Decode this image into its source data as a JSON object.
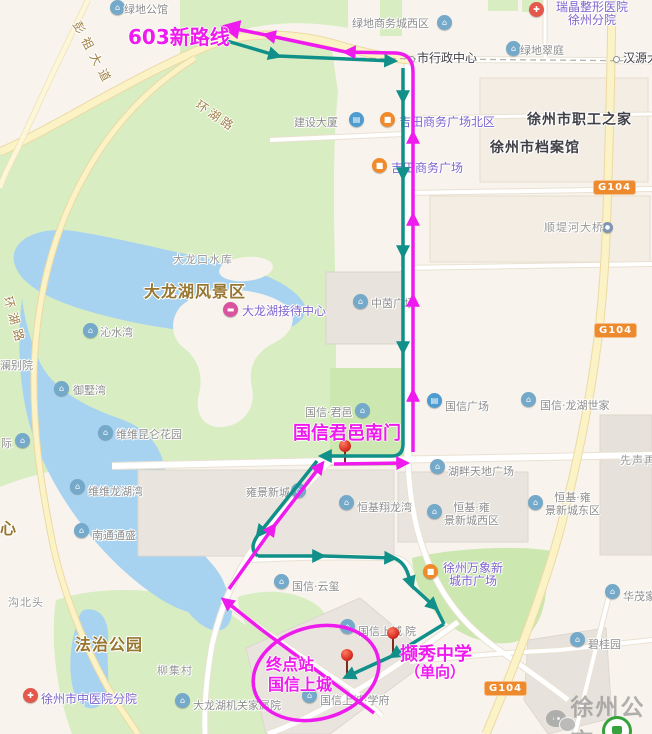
{
  "map": {
    "colors": {
      "route_outbound": "#ef1bee",
      "route_inbound": "#11908a",
      "badge_orange": "#ee8a2e",
      "water": "#a8d3f0",
      "park": "#d8edc2"
    },
    "route": {
      "new_route_label": "603新路线",
      "stop_junyi": "国信君邑南门",
      "terminal_line1": "终点站",
      "terminal_line2": "国信上城",
      "stop_xiexiu": "撷秀中学",
      "oneway_note": "（单向）"
    },
    "watermark": {
      "brand": "徐州公交"
    },
    "badges": [
      {
        "text": "G104",
        "x": 593,
        "y": 180
      },
      {
        "text": "G104",
        "x": 594,
        "y": 323
      },
      {
        "text": "G104",
        "x": 484,
        "y": 681
      }
    ],
    "nodes": [
      {
        "x": 411,
        "y": 59
      },
      {
        "x": 616,
        "y": 59
      }
    ],
    "road_labels": [
      {
        "text": "彭祖大道",
        "x": 84,
        "y": 18,
        "rot": 62,
        "ls": 6
      },
      {
        "text": "环湖路",
        "x": 202,
        "y": 96,
        "rot": 34,
        "ls": 3
      },
      {
        "text": "环湖路",
        "x": 16,
        "y": 294,
        "rot": 74,
        "ls": 5
      }
    ],
    "pins": [
      {
        "name": "junyi-south-gate-pin",
        "x": 345,
        "y": 446
      },
      {
        "name": "xiexiu-middle-school-pin",
        "x": 393,
        "y": 633
      },
      {
        "name": "terminal-guoxin-pin",
        "x": 347,
        "y": 655
      }
    ],
    "pois": [
      {
        "text": "绿地公馆",
        "style": "gray",
        "tx": 124,
        "ty": 3,
        "icon": "house",
        "ix": 110,
        "iy": 0
      },
      {
        "text": "绿地商务城西区",
        "style": "gray",
        "tx": 352,
        "ty": 17,
        "icon": "house",
        "ix": 437,
        "iy": 15
      },
      {
        "lines": [
          "瑞晶整形医院",
          "徐州分院"
        ],
        "style": "purple",
        "tx": 556,
        "ty": 1,
        "icon": "hosp",
        "ix": 529,
        "iy": 2
      },
      {
        "text": "绿地翠庭",
        "style": "gray",
        "tx": 520,
        "ty": 44,
        "icon": "house",
        "ix": 506,
        "iy": 41
      },
      {
        "text": "市行政中心",
        "style": "node",
        "tx": 417,
        "ty": 52
      },
      {
        "text": "汉源大",
        "style": "node",
        "tx": 623,
        "ty": 52
      },
      {
        "text": "建设大厦",
        "style": "gray",
        "tx": 294,
        "ty": 116,
        "icon": "bldg",
        "ix": 349,
        "iy": 112
      },
      {
        "text": "吉田商务广场北区",
        "style": "purple",
        "tx": 399,
        "ty": 116,
        "icon": "shop",
        "ix": 380,
        "iy": 112
      },
      {
        "text": "徐州市职工之家",
        "style": "dark",
        "tx": 527,
        "ty": 114
      },
      {
        "text": "吉田商务广场",
        "style": "purple",
        "tx": 391,
        "ty": 162,
        "icon": "shop",
        "ix": 372,
        "iy": 158
      },
      {
        "text": "徐州市档案馆",
        "style": "dark",
        "tx": 490,
        "ty": 142
      },
      {
        "text": "顺堤河大桥",
        "style": "grayplain",
        "tx": 544,
        "ty": 221,
        "icon": "dot",
        "ix": 602,
        "iy": 222
      },
      {
        "text": "大龙口水库",
        "style": "grayplain",
        "tx": 173,
        "ty": 253
      },
      {
        "text": "大龙湖风景区",
        "style": "brown",
        "tx": 144,
        "ty": 285
      },
      {
        "text": "大龙湖接待中心",
        "style": "purple",
        "tx": 242,
        "ty": 305,
        "icon": "hotel",
        "ix": 223,
        "iy": 302
      },
      {
        "text": "沁水湾",
        "style": "gray",
        "tx": 100,
        "ty": 326,
        "icon": "house",
        "ix": 83,
        "iy": 323
      },
      {
        "text": "观澜别院",
        "style": "gray",
        "tx": -11,
        "ty": 359
      },
      {
        "text": "御墅湾",
        "style": "gray",
        "tx": 73,
        "ty": 384,
        "icon": "house",
        "ix": 54,
        "iy": 381
      },
      {
        "text": "中茵广场",
        "style": "gray",
        "tx": 371,
        "ty": 297,
        "icon": "house",
        "ix": 353,
        "iy": 294
      },
      {
        "text": "维维昆仑花园",
        "style": "gray",
        "tx": 116,
        "ty": 428,
        "icon": "house",
        "ix": 98,
        "iy": 425
      },
      {
        "text": "际",
        "style": "gray",
        "tx": 1,
        "ty": 437,
        "icon": "house",
        "ix": 15,
        "iy": 433
      },
      {
        "text": "国信·君邑",
        "style": "gray",
        "tx": 305,
        "ty": 406,
        "icon": "house",
        "ix": 355,
        "iy": 403
      },
      {
        "text": "国信广场",
        "style": "gray",
        "tx": 445,
        "ty": 400,
        "icon": "bldg",
        "ix": 427,
        "iy": 393
      },
      {
        "text": "国信·龙湖世家",
        "style": "gray",
        "tx": 540,
        "ty": 399,
        "icon": "house",
        "ix": 521,
        "iy": 392
      },
      {
        "text": "湖畔天地广场",
        "style": "gray",
        "tx": 448,
        "ty": 465,
        "icon": "house",
        "ix": 430,
        "iy": 459
      },
      {
        "text": "先声再",
        "style": "grayplain",
        "tx": 620,
        "ty": 454
      },
      {
        "text": "维维龙湖湾",
        "style": "gray",
        "tx": 88,
        "ty": 485,
        "icon": "house",
        "ix": 70,
        "iy": 479
      },
      {
        "text": "雍景新城",
        "style": "gray",
        "tx": 246,
        "ty": 486,
        "icon": "house",
        "ix": 291,
        "iy": 483
      },
      {
        "text": "恒基翔龙湾",
        "style": "gray",
        "tx": 357,
        "ty": 501,
        "icon": "house",
        "ix": 339,
        "iy": 495
      },
      {
        "lines": [
          "恒基·雍",
          "景新城西区"
        ],
        "style": "gray",
        "tx": 444,
        "ty": 501,
        "icon": "house",
        "ix": 427,
        "iy": 504
      },
      {
        "lines": [
          "恒基·雍",
          "景新城东区"
        ],
        "style": "gray",
        "tx": 545,
        "ty": 491,
        "icon": "house",
        "ix": 528,
        "iy": 495
      },
      {
        "text": "南通通盛",
        "style": "gray",
        "tx": 92,
        "ty": 529,
        "icon": "house",
        "ix": 74,
        "iy": 523
      },
      {
        "text": "心",
        "style": "brown",
        "tx": 0,
        "ty": 522
      },
      {
        "text": "沟北头",
        "style": "grayplain",
        "tx": 8,
        "ty": 596
      },
      {
        "text": "国信·云玺",
        "style": "gray",
        "tx": 292,
        "ty": 580,
        "icon": "house",
        "ix": 274,
        "iy": 574
      },
      {
        "lines": [
          "徐州万象新",
          "城市广场"
        ],
        "style": "purple",
        "tx": 443,
        "ty": 562,
        "icon": "shop",
        "ix": 423,
        "iy": 564
      },
      {
        "text": "法治公园",
        "style": "brown",
        "tx": 75,
        "ty": 638
      },
      {
        "text": "柳集村",
        "style": "grayplain",
        "tx": 157,
        "ty": 664
      },
      {
        "text": "华茂家",
        "style": "gray",
        "tx": 623,
        "ty": 590,
        "icon": "house",
        "ix": 605,
        "iy": 584
      },
      {
        "text": "国信上城",
        "style": "gray",
        "tx": 358,
        "ty": 625,
        "icon": "house",
        "ix": 340,
        "iy": 619
      },
      {
        "text": "院",
        "style": "gray",
        "tx": 405,
        "ty": 625
      },
      {
        "text": "碧桂园",
        "style": "gray",
        "tx": 588,
        "ty": 638,
        "icon": "house",
        "ix": 570,
        "iy": 632
      },
      {
        "text": "徐州市中医院分院",
        "style": "purple",
        "tx": 41,
        "ty": 693,
        "icon": "hosp",
        "ix": 23,
        "iy": 688
      },
      {
        "text": "大龙湖机关家属院",
        "style": "gray",
        "tx": 193,
        "ty": 699,
        "icon": "house",
        "ix": 175,
        "iy": 693
      },
      {
        "text": "国信上城·学府",
        "style": "gray",
        "tx": 320,
        "ty": 694,
        "icon": "house",
        "ix": 302,
        "iy": 688
      }
    ]
  }
}
